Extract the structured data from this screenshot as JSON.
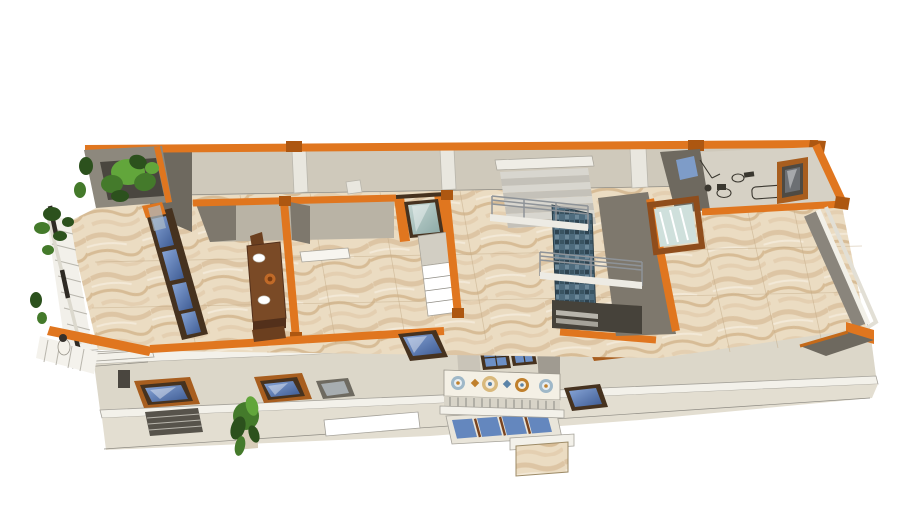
{
  "scene": {
    "type": "3d-architectural-cutaway-render",
    "view": "axonometric top-down cutaway of an upper house floor with lower storeys visible below",
    "parts": {
      "left_balcony": "balcony with white railing, climbing vines and planter",
      "dining_room": "room with wooden dining table and place settings",
      "hall": "central hall with teal glass door and white shelf cabinet",
      "staircase": "double-flight stair with metal railings and blue mosaic feature wall",
      "bathroom": "top-right bathroom with line-art fixtures and framed window",
      "terrace": "large marble-floored room/terrace with low parapet at right",
      "front_balcony": "protruding balcony with decorative patterned tile parapet and french doors",
      "lower_floor": "stepped lower facade with angled skylight windows, awning, plant and stone pillar"
    }
  },
  "colors": {
    "background": "#ffffff",
    "orange": "#e0761f",
    "orangeDark": "#ad5711",
    "wallLight": "#cfc9bb",
    "wallMid": "#b9b3a5",
    "wallDark": "#6e695f",
    "wallShadow": "#7e786d",
    "slab": "#f3f1ea",
    "lowerWall": "#dcd7c9",
    "lowerWall2": "#e3ded1",
    "woodDark": "#46321f",
    "woodOrange": "#a85e1f",
    "glassBlueFlat": "#5e7fb9",
    "glassGray": "#a7adb0",
    "glassTeal": "#b7ccc8",
    "metal": "#8e9398",
    "darkVoid": "#46423a",
    "tableWood": "#7a4a26",
    "tableWoodDark": "#53301b",
    "plantBright": "#62a63b",
    "plantMid": "#447a2b",
    "plantDark": "#2c511d",
    "tileWhite": "#f4f0e5",
    "tileBlue": "#5b84a8",
    "tileOrange": "#c0802c",
    "awning": "#57534b",
    "white": "#ffffff"
  }
}
